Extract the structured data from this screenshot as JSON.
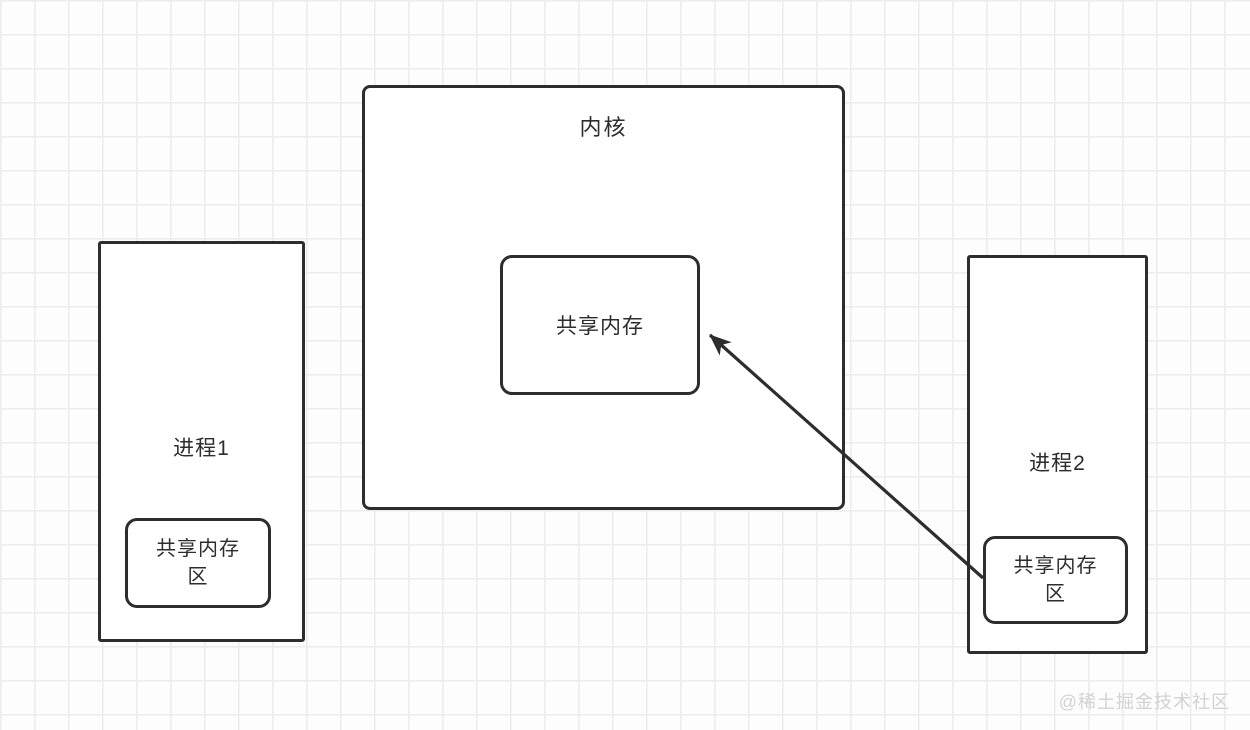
{
  "diagram": {
    "kernel": {
      "label": "内核",
      "shared_memory": {
        "label": "共享内存"
      }
    },
    "process1": {
      "label": "进程1",
      "shared_area": {
        "label": "共享内存区"
      }
    },
    "process2": {
      "label": "进程2",
      "shared_area": {
        "label": "共享内存区"
      }
    },
    "arrow": {
      "from": "process2.shared_area",
      "to": "kernel.shared_memory",
      "direction": "up-left"
    }
  },
  "watermark": {
    "text": "@稀土掘金技术社区"
  },
  "colors": {
    "stroke": "#2d2d2d",
    "box_fill": "#ffffff",
    "grid_line": "#ececec",
    "background": "#fdfdfd",
    "watermark": "#d2d2d2"
  }
}
